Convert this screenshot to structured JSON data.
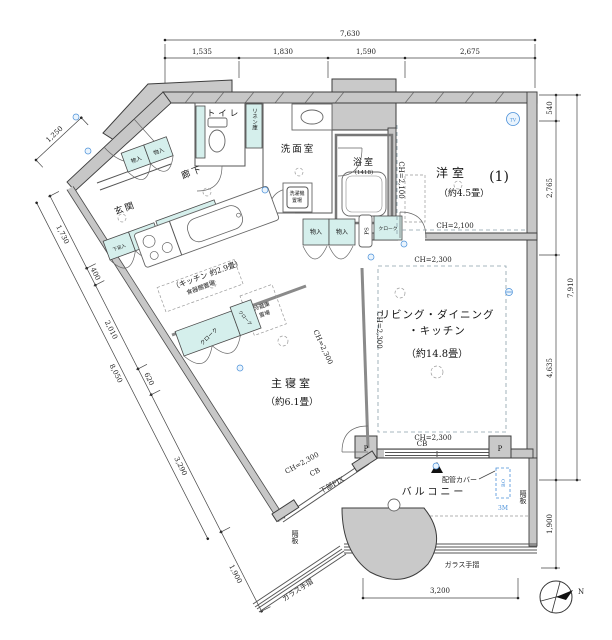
{
  "plan": {
    "rooms": {
      "western": {
        "name": "洋室",
        "number": "(1)",
        "size": "（約4.5畳）"
      },
      "ldk": {
        "name1": "リビング・ダイニング",
        "name2": "・キッチン",
        "size": "（約14.8畳）"
      },
      "master": {
        "name": "主寝室",
        "size": "（約6.1畳）"
      },
      "kitchen": {
        "name": "（キッチン 約2.9畳）"
      },
      "entrance": {
        "name": "玄関"
      },
      "hallway": {
        "name": "廊下"
      },
      "toilet": {
        "name": "トイレ"
      },
      "linen": {
        "name": "リネン庫"
      },
      "washroom": {
        "name": "洗面室"
      },
      "bathroom": {
        "name": "浴室",
        "size": "(1418)"
      },
      "balcony": {
        "name": "バルコニー"
      }
    },
    "fixtures": {
      "washer1": "洗濯機",
      "washer2": "置場",
      "cupboard": "食器棚置場",
      "fridge1": "冷蔵庫",
      "fridge2": "置場",
      "storage": "物入",
      "shoe": "下足入",
      "cloak": "クローク",
      "ps": "PS"
    },
    "notes": {
      "ch2300": "CH=2,300",
      "ch2100": "CH=2,100",
      "cb": "CB",
      "pillar": "P",
      "pipe_cover": "配管カバー",
      "glass_rail": "ガラス手摺",
      "divider": "隔板",
      "fix": "下部FIX",
      "bo": "BO",
      "m3": "3M",
      "tv": "TV",
      "north": "N"
    },
    "dims": {
      "top_total": "7,630",
      "top_segs": [
        "1,535",
        "1,830",
        "1,590",
        "2,675"
      ],
      "right": {
        "d540": "540",
        "d2765": "2,765",
        "d7910": "7,910",
        "d4635": "4,635",
        "d1900": "1,900"
      },
      "left": {
        "d1250": "1,250",
        "d1730": "1,730",
        "d400": "400",
        "d2010": "2,010",
        "d8050": "8,050",
        "d620": "620",
        "d3290": "3,290",
        "d1900": "1,900"
      },
      "bottom": "3,200"
    },
    "colors": {
      "storage_fill": "#d5efec",
      "wall_fill": "#c7c7c7",
      "accent_blue": "#4a90d9"
    }
  }
}
